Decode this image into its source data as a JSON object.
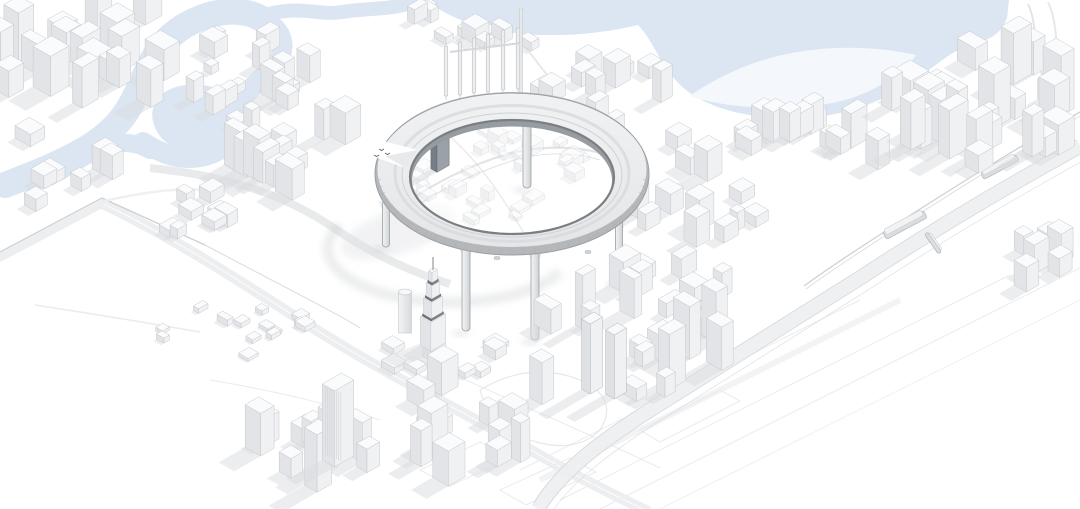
{
  "meta": {
    "subject": "monochrome-aerial-architectural-render",
    "description": "White massing-model aerial view of a dense downtown with a winding blue waterway and lagoon at top, a giant elevated ring structure on slender columns over the city centre, a tall stepped spire tower, elevated highways and rail lines; no visible text",
    "canvas": {
      "w": 1080,
      "h": 509
    }
  },
  "colors": {
    "background": "#ffffff",
    "water": "#dce6f2",
    "water_highlight": "#f4f8fc",
    "building_top": "#fafbfc",
    "building_right": "#f0f1f3",
    "building_left": "#e2e4e7",
    "building_outline": "#c5c8cc",
    "building_shadow": "#dadcdf",
    "ground_line": "#e9ebee",
    "road_band": "#eceef0",
    "road_line": "#d5d8db",
    "rail_line": "#c9ccd0",
    "ring_deck_light": "#f1f2f3",
    "ring_deck_dark": "#e3e5e7",
    "ring_wall": "#b5b8bb",
    "ring_inner_wall": "#979ca0",
    "ring_rim": "#7b7e82",
    "ring_edge": "#9da0a4",
    "ring_rib": "#a9acaf",
    "leg_light": "#f3f4f5",
    "leg_dark": "#d0d3d5",
    "leg_outline": "#9aa0a4",
    "dark_tower_front": "#757d85",
    "dark_tower_side": "#9aa1a8",
    "dark_tower_top": "#c9ced3",
    "band_dark_top": "#9da1a5",
    "band_dark_right": "#83878b",
    "band_dark_left": "#6f7377",
    "shadow_soft": "#c8cbce",
    "notch_mark": "#666b70"
  },
  "scene": {
    "water": {
      "strokes": [
        {
          "d": "M 5,185 C 70,160 110,142 130,106 C 148,74 152,44 186,25 C 212,10 242,7 262,19",
          "w": 26
        },
        {
          "d": "M 262,19 C 292,34 286,58 264,76 C 246,91 238,104 236,122 C 233,142 222,153 200,157 C 178,161 158,152 143,142",
          "w": 20
        },
        {
          "d": "M 150,150 C 120,132 92,152 62,170 C 45,180 25,184 8,183",
          "w": 18
        },
        {
          "d": "M 262,16 C 298,4 318,16 342,12 C 366,8 384,10 408,4 C 416,2 424,1 430,0",
          "w": 14
        }
      ],
      "blobs": [
        {
          "d": "M 165,92 C 185,80 215,82 228,98 C 240,113 236,136 218,146 C 198,157 172,152 160,136 C 148,120 150,102 165,92 Z",
          "color": "water"
        },
        {
          "d": "M 426,0 C 448,18 478,28 514,33 C 556,38 600,34 638,25 C 658,46 662,76 696,97 C 734,119 796,124 844,112 C 890,101 920,76 948,56 C 972,40 996,46 1007,18 L 1009,0 Z",
          "color": "water"
        },
        {
          "d": "M 690,96 C 730,110 800,112 845,100 C 880,90 906,70 916,55 C 880,47 838,45 798,52 C 758,58 718,76 690,96 Z",
          "color": "water_highlight"
        }
      ]
    },
    "roads": [
      {
        "d": "M 0,256 L 104,201 C 180,237 250,285 330,335 C 400,378 470,412 540,452 C 580,475 620,495 650,509",
        "w": 5,
        "color": "road_band",
        "opacity": 1
      },
      {
        "d": "M 0,256 L 104,201 C 180,237 250,285 330,335 C 400,378 470,412 540,452 C 580,475 620,495 650,509",
        "w": 5,
        "color": "road_band",
        "opacity": 1,
        "dx": -3,
        "dy": 5
      },
      {
        "d": "M 0,252 L 102,198 L 205,245",
        "w": 1.4,
        "color": "rail_line",
        "opacity": 0.9
      },
      {
        "d": "M 205,245 C 290,290 340,315 360,328",
        "w": 1,
        "color": "rail_line",
        "opacity": 0.7
      },
      {
        "d": "M 150,168 C 250,178 300,205 340,232 C 375,256 420,275 450,284",
        "w": 8,
        "color": "road_line",
        "opacity": 0.55
      },
      {
        "d": "M 1080,146 C 1000,190 930,232 860,278 C 790,322 720,366 650,410 C 600,442 560,472 538,509",
        "w": 15,
        "color": "road_band",
        "opacity": 0.9
      },
      {
        "d": "M 1080,146 C 1000,190 930,232 860,278 C 790,322 720,366 650,410 C 600,442 560,472 538,509",
        "w": 0.9,
        "color": "road_line",
        "opacity": 0.9,
        "dx": 4,
        "dy": 6
      },
      {
        "d": "M 1080,146 C 1000,190 930,232 860,278 C 790,322 720,366 650,410 C 600,442 560,472 538,509",
        "w": 0.9,
        "color": "road_line",
        "opacity": 0.9,
        "dx": -4,
        "dy": -6
      },
      {
        "d": "M 1080,146 C 1000,190 930,232 860,278 C 790,322 720,366 650,410 C 600,442 560,472 538,509",
        "w": 0.8,
        "color": "road_line",
        "opacity": 0.7,
        "dx": 8,
        "dy": 12
      },
      {
        "d": "M 1080,112 C 1000,158 940,196 878,236 C 850,254 826,270 804,286",
        "w": 1.3,
        "color": "rail_line",
        "opacity": 0.9
      },
      {
        "d": "M 1080,112 C 1000,158 940,196 878,236 C 850,254 826,270 804,286",
        "w": 0.8,
        "color": "rail_line",
        "opacity": 0.7,
        "dx": 2,
        "dy": 3
      },
      {
        "d": "M 520,40 C 540,66 552,82 564,96",
        "w": 2,
        "color": "road_line",
        "opacity": 0.6
      },
      {
        "d": "M 104,201 C 145,192 175,188 205,190",
        "w": 2.5,
        "color": "road_band",
        "opacity": 0.9
      }
    ],
    "faint_lines": [
      {
        "d": "M 540,480 L 900,300",
        "w": 6,
        "color": "road_band",
        "opacity": 0.7
      },
      {
        "d": "M 560,500 L 1010,275",
        "w": 1,
        "color": "ground_line",
        "opacity": 1
      },
      {
        "d": "M 520,470 L 860,300",
        "w": 1,
        "color": "ground_line",
        "opacity": 1
      },
      {
        "d": "M 600,509 L 1080,268",
        "w": 1,
        "color": "ground_line",
        "opacity": 1
      },
      {
        "d": "M 660,509 L 1080,300",
        "w": 0.8,
        "color": "ground_line",
        "opacity": 0.9
      },
      {
        "d": "M 420,470 l 60,-28 l 30,16 l -60,28 z",
        "w": 1,
        "color": "ground_line",
        "opacity": 1
      },
      {
        "d": "M 500,490 l 70,-32 l 26,14 l -70,33 z",
        "w": 1,
        "color": "ground_line",
        "opacity": 1
      },
      {
        "d": "M 640,430 l 80,-40 l 20,11 l -80,41 z",
        "w": 1,
        "color": "ground_line",
        "opacity": 1
      },
      {
        "d": "M 35,305 Q 120,318 200,332",
        "w": 1.5,
        "color": "ground_line",
        "opacity": 1
      },
      {
        "d": "M 210,380 Q 300,395 380,420",
        "w": 1,
        "color": "ground_line",
        "opacity": 1
      },
      {
        "d": "M 420,360 C 500,395 580,430 660,468",
        "w": 1,
        "color": "ground_line",
        "opacity": 1
      },
      {
        "d": "M 480,390 Q 530,360 580,380 Q 620,398 600,430 Q 575,455 530,440 Q 490,428 480,390",
        "w": 1.2,
        "color": "road_line",
        "opacity": 0.6
      },
      {
        "d": "M 1028,4 C 1040,30 1030,55 1045,80 C 1055,98 1050,110 1056,122",
        "w": 2,
        "color": "road_line",
        "opacity": 0.7
      },
      {
        "d": "M 1048,2 C 1060,28 1052,50 1066,76",
        "w": 2,
        "color": "road_line",
        "opacity": 0.6
      }
    ],
    "interior_roads": [
      {
        "d": "M 398,208 Q 455,168 515,152 Q 565,142 608,155",
        "w": 2.2,
        "color": "road_line",
        "opacity": 0.7
      },
      {
        "d": "M 402,215 Q 460,176 518,159 Q 562,148 600,160",
        "w": 0.8,
        "color": "rail_line",
        "opacity": 0.7
      },
      {
        "d": "M 430,120 Q 470,150 500,195 Q 515,218 525,235",
        "w": 1.5,
        "color": "road_line",
        "opacity": 0.5
      }
    ],
    "clusters_back": [
      {
        "name": "northwest-towers",
        "cx": 95,
        "cy": 60,
        "rx": 105,
        "ry": 58,
        "n": 18,
        "sMin": 5,
        "sMax": 11,
        "hMin": 20,
        "hMax": 62,
        "seed": 11
      },
      {
        "name": "west-edge",
        "cx": 55,
        "cy": 165,
        "rx": 60,
        "ry": 45,
        "n": 7,
        "sMin": 5,
        "sMax": 9,
        "hMin": 10,
        "hMax": 32,
        "seed": 12
      },
      {
        "name": "river-bend-blocks",
        "cx": 258,
        "cy": 82,
        "rx": 85,
        "ry": 48,
        "n": 16,
        "sMin": 4,
        "sMax": 9,
        "hMin": 8,
        "hMax": 30,
        "seed": 13
      },
      {
        "name": "midwest-cluster",
        "cx": 292,
        "cy": 148,
        "rx": 75,
        "ry": 50,
        "n": 13,
        "sMin": 5,
        "sMax": 10,
        "hMin": 14,
        "hMax": 48,
        "seed": 14
      },
      {
        "name": "north-bank-blocks",
        "cx": 480,
        "cy": 30,
        "rx": 100,
        "ry": 22,
        "n": 10,
        "sMin": 4,
        "sMax": 8,
        "hMin": 6,
        "hMax": 18,
        "seed": 15
      },
      {
        "name": "east-river-blocks",
        "cx": 600,
        "cy": 92,
        "rx": 65,
        "ry": 42,
        "n": 11,
        "sMin": 4,
        "sMax": 9,
        "hMin": 10,
        "hMax": 34,
        "seed": 16
      },
      {
        "name": "lagoon-shore-row",
        "cx": 770,
        "cy": 152,
        "rx": 125,
        "ry": 30,
        "n": 15,
        "sMin": 5,
        "sMax": 10,
        "hMin": 14,
        "hMax": 45,
        "seed": 17
      },
      {
        "name": "northeast-district",
        "cx": 975,
        "cy": 115,
        "rx": 100,
        "ry": 60,
        "n": 26,
        "sMin": 5,
        "sMax": 11,
        "hMin": 16,
        "hMax": 60,
        "seed": 18
      },
      {
        "name": "east-edge",
        "cx": 1040,
        "cy": 245,
        "rx": 38,
        "ry": 55,
        "n": 6,
        "sMin": 5,
        "sMax": 9,
        "hMin": 10,
        "hMax": 30,
        "seed": 19
      },
      {
        "name": "south-of-lagoon-mid",
        "cx": 700,
        "cy": 215,
        "rx": 70,
        "ry": 30,
        "n": 10,
        "sMin": 4,
        "sMax": 9,
        "hMin": 10,
        "hMax": 36,
        "seed": 26
      },
      {
        "name": "warehouse-grid",
        "cx": 235,
        "cy": 335,
        "rx": 85,
        "ry": 30,
        "n": 14,
        "sMin": 3,
        "sMax": 6,
        "hMin": 3,
        "hMax": 7,
        "seed": 23
      },
      {
        "name": "west-of-ring-lowrise",
        "cx": 205,
        "cy": 212,
        "rx": 55,
        "ry": 26,
        "n": 8,
        "sMin": 4,
        "sMax": 8,
        "hMin": 6,
        "hMax": 16,
        "seed": 24
      }
    ],
    "clusters_front1": [
      {
        "name": "business-bay",
        "cx": 640,
        "cy": 330,
        "rx": 105,
        "ry": 65,
        "n": 22,
        "sMin": 4,
        "sMax": 10,
        "hMin": 12,
        "hMax": 58,
        "seed": 20
      },
      {
        "name": "burj-podium-blocks",
        "cx": 445,
        "cy": 362,
        "rx": 70,
        "ry": 26,
        "n": 10,
        "sMin": 4,
        "sMax": 8,
        "hMin": 5,
        "hMax": 14,
        "seed": 25
      }
    ],
    "clusters_front2": [
      {
        "name": "south-center-towers",
        "cx": 480,
        "cy": 430,
        "rx": 85,
        "ry": 55,
        "n": 13,
        "sMin": 5,
        "sMax": 10,
        "hMin": 16,
        "hMax": 55,
        "seed": 21
      },
      {
        "name": "southwest-towers",
        "cx": 300,
        "cy": 455,
        "rx": 90,
        "ry": 48,
        "n": 11,
        "sMin": 5,
        "sMax": 10,
        "hMin": 18,
        "hMax": 65,
        "seed": 22
      }
    ],
    "interior_fabric": {
      "name": "ring-interior-fabric",
      "cx": 505,
      "cy": 178,
      "rx": 92,
      "ry": 48,
      "n": 30,
      "sMin": 3,
      "sMax": 7,
      "hMin": 3,
      "hMax": 12,
      "seed": 30,
      "opacity": 0.55
    },
    "ring": {
      "cx": 512,
      "cy": 174,
      "outerRx": 137,
      "outerRy": 81,
      "innerRx": 102,
      "innerRy": 57,
      "innerDy": 3,
      "ribCount": 72,
      "legs": [
        {
          "x": 527,
          "y1": 100,
          "y2": 188,
          "w": 8,
          "far": true
        },
        {
          "x": 386,
          "y1": 201,
          "y2": 247,
          "w": 7
        },
        {
          "x": 466,
          "y1": 245,
          "y2": 331,
          "w": 8
        },
        {
          "x": 535,
          "y1": 250,
          "y2": 340,
          "w": 8
        },
        {
          "x": 619,
          "y1": 220,
          "y2": 283,
          "w": 7
        }
      ],
      "pods": [
        {
          "x": 588,
          "y": 252
        },
        {
          "x": 497,
          "y": 258
        }
      ],
      "notch": {
        "outer": "372,138 418,150 406,168 366,154",
        "shade": "418,150 406,168 385,156",
        "marks": [
          {
            "x": 379,
            "y": 149
          },
          {
            "x": 385,
            "y": 153
          },
          {
            "x": 374,
            "y": 155
          }
        ]
      },
      "shadow_arc": "M 340,225 A 118,52 0 0 0 560,272",
      "shadow_blob": {
        "cx": 398,
        "cy": 232,
        "rx": 60,
        "ry": 22,
        "rot": -18
      }
    },
    "pylons": {
      "xs": [
        446,
        460,
        474,
        488,
        503,
        518
      ],
      "topY": [
        46,
        42,
        38,
        34,
        30,
        28
      ],
      "baseY": [
        96,
        95,
        93,
        92,
        90,
        89
      ],
      "beam": {
        "x1": 450,
        "y1": 52,
        "x2": 521,
        "y2": 43
      },
      "mast": {
        "x": 521,
        "y1": 8,
        "y2": 95
      }
    },
    "landmarks": {
      "dark_tower": {
        "x": 440,
        "y": 167,
        "a": 7,
        "b": 3.5,
        "h": 37
      },
      "burj": {
        "x": 433,
        "baseY": 344,
        "spireH": 13,
        "shadow": "419,344 441,350 399,368 381,359",
        "tiers": [
          {
            "a": 8.5,
            "b": 6,
            "h": 29
          },
          {
            "a": 6.5,
            "b": 4.5,
            "h": 16
          },
          {
            "a": 4.6,
            "b": 3.2,
            "h": 13
          },
          {
            "a": 3,
            "b": 2,
            "h": 10
          }
        ]
      },
      "cylinder_tower": {
        "x": 405,
        "baseY": 333,
        "r": 6.5,
        "h": 41
      },
      "ribbed_tower": {
        "x": 338,
        "baseY": 458,
        "a": 11,
        "b": 7,
        "h": 76,
        "ribN": 8
      },
      "twin_frame_towers": [
        {
          "x": 592,
          "y": 388,
          "a": 7,
          "b": 5,
          "h": 70
        },
        {
          "x": 616,
          "y": 393,
          "a": 7,
          "b": 5,
          "h": 64
        }
      ]
    },
    "stations": [
      {
        "x": 905,
        "y": 225,
        "wid": 46,
        "hei": 8,
        "rot": -28
      },
      {
        "x": 1000,
        "y": 167,
        "wid": 40,
        "hei": 7,
        "rot": -28
      },
      {
        "x": 933,
        "y": 243,
        "wid": 24,
        "hei": 4,
        "rot": 55
      }
    ]
  }
}
